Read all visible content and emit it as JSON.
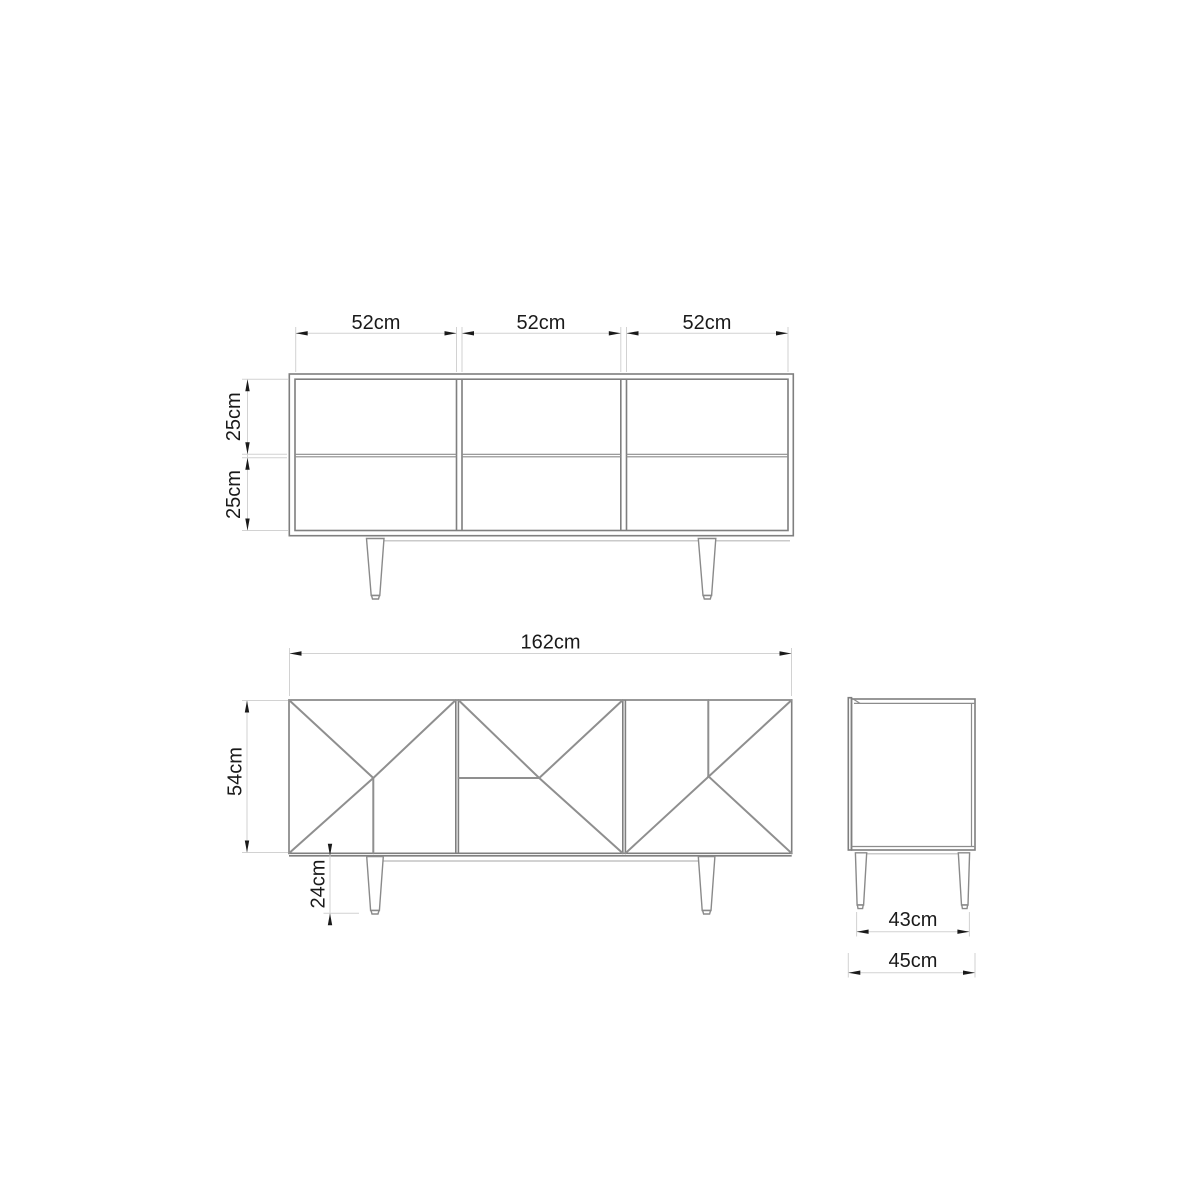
{
  "document": {
    "type": "furniture technical drawing",
    "subject": "sideboard with three doors and tapered legs",
    "unit": "cm",
    "background": "#ffffff"
  },
  "colors": {
    "furniture_line": "#7f7f7f",
    "door_pattern_line": "#8f8f8f",
    "dimension_line": "#d2d2d2",
    "text_and_arrows": "#1a1a1a"
  },
  "views": {
    "top": {
      "name": "carcass elevation (open compartments)",
      "columns": 3,
      "rows": 2,
      "compartment_widths": [
        "52cm",
        "52cm",
        "52cm"
      ],
      "shelf_heights": [
        "25cm",
        "25cm"
      ]
    },
    "front": {
      "name": "front elevation (geometric doors)",
      "doors": 3,
      "width": "162cm",
      "height": "54cm",
      "leg_height": "24cm"
    },
    "side": {
      "name": "side elevation",
      "leg_span": "43cm",
      "depth": "45cm"
    }
  }
}
